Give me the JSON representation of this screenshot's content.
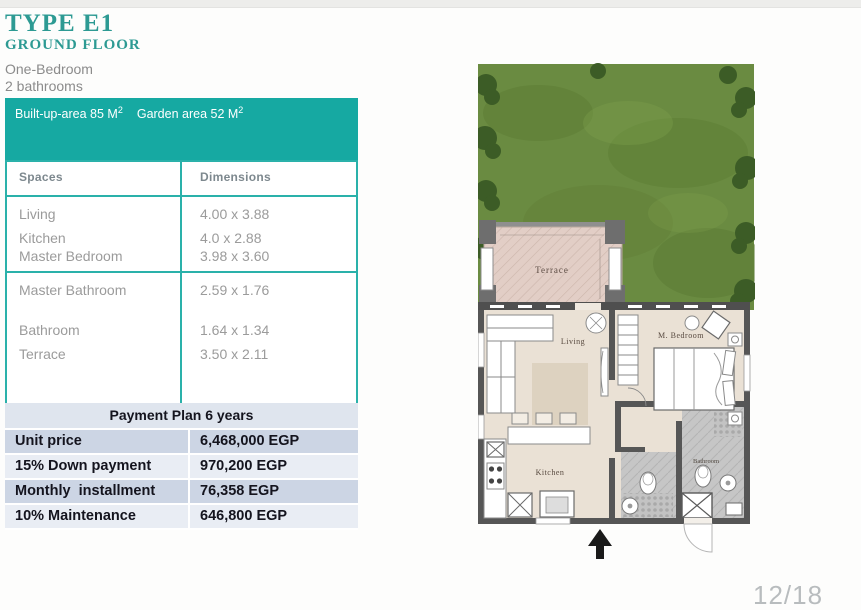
{
  "page": {
    "page_number": "12/18"
  },
  "header": {
    "title": "TYPE E1",
    "subtitle": "GROUND FLOOR",
    "type_line1": "One-Bedroom",
    "type_line2": "2 bathrooms"
  },
  "area_banner": {
    "built_up_label": "Built-up-area 85 M",
    "built_up_sup": "2",
    "garden_label": "Garden area 52 M",
    "garden_sup": "2"
  },
  "spaces_table": {
    "headers": [
      "Spaces",
      "Dimensions"
    ],
    "group1": {
      "rows": [
        [
          "Living",
          "4.00 x 3.88"
        ],
        [
          "Kitchen",
          "4.0 x 2.88"
        ],
        [
          "Master Bedroom",
          "3.98 x 3.60"
        ]
      ]
    },
    "group2": {
      "rows": [
        [
          "Master Bathroom",
          "2.59 x 1.76"
        ],
        [
          "Bathroom",
          "1.64 x 1.34"
        ],
        [
          "Terrace",
          "3.50 x 2.11"
        ]
      ]
    }
  },
  "payment_plan": {
    "title": "Payment Plan  6 years",
    "rows": [
      [
        "Unit price",
        "6,468,000 EGP"
      ],
      [
        "15% Down payment",
        "970,200 EGP"
      ],
      [
        "Monthly  installment",
        "76,358 EGP"
      ],
      [
        "10% Maintenance",
        "646,800 EGP"
      ]
    ]
  },
  "floor_plan": {
    "labels": {
      "terrace": "Terrace",
      "living": "Living",
      "bedroom": "M. Bedroom",
      "kitchen": "Kitchen",
      "bathroom": "Bathroom"
    }
  },
  "colors": {
    "accent_teal": "#16a9a2",
    "title_teal": "#2d9a93",
    "table_border_teal": "#2ab1aa",
    "payment_row_dark": "#ccd5e4",
    "payment_row_light": "#e9edf4",
    "garden_green": "#6a8b41",
    "wall_gray": "#565656",
    "floor_beige": "#eae1d4",
    "terrace_pink": "#e2cec6"
  }
}
